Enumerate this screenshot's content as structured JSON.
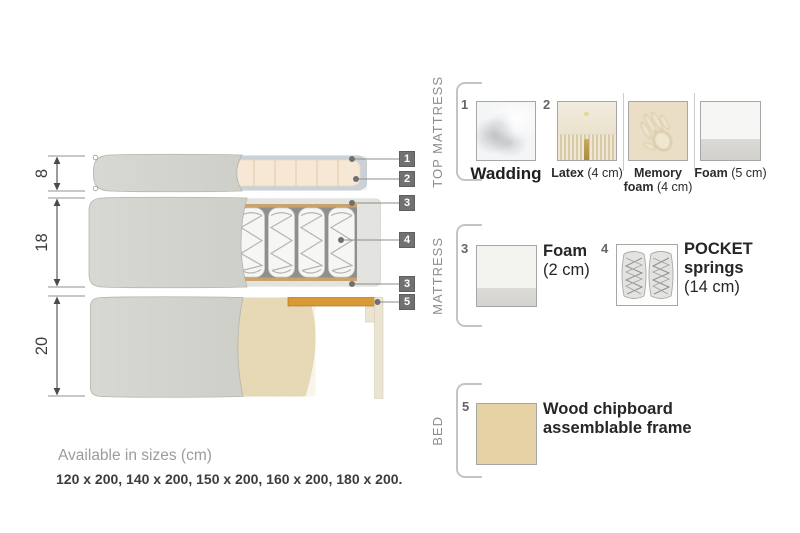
{
  "diagram": {
    "dimension_labels": [
      "8",
      "18",
      "20"
    ],
    "callouts": {
      "c1": "1",
      "c2": "2",
      "c3": "3",
      "c4": "4",
      "c3b": "3",
      "c5": "5"
    }
  },
  "legend": {
    "top_mattress": {
      "title": "TOP MATTRESS",
      "items": [
        {
          "num": "1",
          "name": "Wadding",
          "detail": ""
        },
        {
          "num": "2",
          "name": "Latex",
          "detail": "(4 cm)"
        },
        {
          "num": "",
          "name_line1": "Memory",
          "name_line2": "foam",
          "detail": "(4 cm)"
        },
        {
          "num": "",
          "name": "Foam",
          "detail": "(5 cm)"
        }
      ]
    },
    "mattress": {
      "title": "MATTRESS",
      "items": [
        {
          "num": "3",
          "name": "Foam",
          "detail": "(2 cm)"
        },
        {
          "num": "4",
          "name_line1": "POCKET",
          "name_line2": "springs",
          "detail": "(14 cm)"
        }
      ]
    },
    "bed": {
      "title": "BED",
      "items": [
        {
          "num": "5",
          "name_line1": "Wood chipboard",
          "name_line2": "assemblable frame"
        }
      ]
    }
  },
  "footer": {
    "sizes_title": "Available in sizes (cm)",
    "sizes_list": "120 x 200, 140 x 200, 150 x 200, 160 x 200, 180 x 200."
  },
  "colors": {
    "callout_bg": "#717171",
    "cover_gray": "#d5d5d0",
    "foam_cream": "#f7e8d5",
    "wadding_blue_gray": "#ccd4d9",
    "wood_slat": "#d79a35",
    "chipboard_tan": "#e9dcba"
  }
}
